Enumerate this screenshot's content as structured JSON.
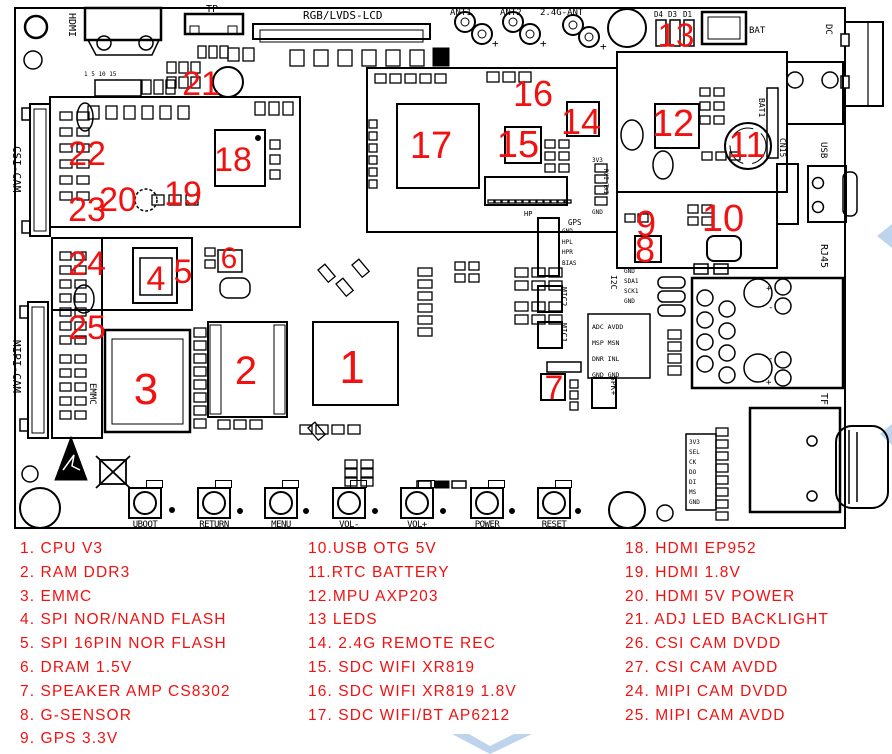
{
  "colors": {
    "annotation": "#f21111",
    "line": "#000000",
    "watermark": "#bdd4ec",
    "bg": "#ffffff"
  },
  "board": {
    "connector_labels": {
      "hdmi": "HDMI",
      "tp": "TP",
      "lcd": "RGB/LVDS-LCD",
      "ant1": "ANT1",
      "ant2": "ANT2",
      "ant_24g": "2.4G-ANT",
      "d4": "D4",
      "d3": "D3",
      "d1": "D1",
      "bat": "BAT",
      "dc": "DC",
      "csi_cam": "CSI-CAM",
      "mipi_cam": "MIPI-CAM",
      "emmc": "EMMC",
      "bat1": "BAT1",
      "cn15": "CN15",
      "usb": "USB",
      "rj45": "RJ45",
      "tf": "TF",
      "mic1": "MIC1",
      "mic2": "MIC2",
      "spk": "SPK+",
      "hp": "HP",
      "gps": "GPS",
      "i2c": "I2C"
    },
    "pins": {
      "hdmi_row": "1 5 10 15",
      "hp": [
        "GND",
        "HPL",
        "HPR",
        "BIAS"
      ],
      "i2c": [
        "GND",
        "SDA1",
        "SCK1",
        "GND"
      ],
      "adc": [
        "ADC AVDD",
        "MSP MSN",
        "DNR INL",
        "GND GND"
      ],
      "tf": [
        "3V3",
        "SEL",
        "CK",
        "DO",
        "DI",
        "MS",
        "GND"
      ],
      "gps_top": "3V3",
      "gps_side": "RXI TXI",
      "gps_bottom": "GND",
      "plus": "+",
      "minus": "-"
    }
  },
  "markers": [
    {
      "n": "1",
      "x": 352,
      "y": 367,
      "s": 46
    },
    {
      "n": "2",
      "x": 246,
      "y": 371,
      "s": 40
    },
    {
      "n": "3",
      "x": 146,
      "y": 390,
      "s": 44
    },
    {
      "n": "4",
      "x": 156,
      "y": 279,
      "s": 34
    },
    {
      "n": "5",
      "x": 183,
      "y": 272,
      "s": 34
    },
    {
      "n": "6",
      "x": 229,
      "y": 259,
      "s": 30
    },
    {
      "n": "7",
      "x": 554,
      "y": 388,
      "s": 34
    },
    {
      "n": "8",
      "x": 645,
      "y": 250,
      "s": 36
    },
    {
      "n": "9",
      "x": 646,
      "y": 224,
      "s": 36
    },
    {
      "n": "10",
      "x": 723,
      "y": 219,
      "s": 38
    },
    {
      "n": "11",
      "x": 747,
      "y": 145,
      "s": 36
    },
    {
      "n": "12",
      "x": 673,
      "y": 124,
      "s": 38
    },
    {
      "n": "13",
      "x": 676,
      "y": 35,
      "s": 33
    },
    {
      "n": "14",
      "x": 581,
      "y": 122,
      "s": 36
    },
    {
      "n": "15",
      "x": 518,
      "y": 145,
      "s": 38
    },
    {
      "n": "16",
      "x": 533,
      "y": 94,
      "s": 36
    },
    {
      "n": "17",
      "x": 431,
      "y": 146,
      "s": 38
    },
    {
      "n": "18",
      "x": 233,
      "y": 160,
      "s": 34
    },
    {
      "n": "19",
      "x": 183,
      "y": 194,
      "s": 34
    },
    {
      "n": "20",
      "x": 118,
      "y": 200,
      "s": 34
    },
    {
      "n": "21",
      "x": 201,
      "y": 84,
      "s": 34
    },
    {
      "n": "22",
      "x": 87,
      "y": 154,
      "s": 34
    },
    {
      "n": "23",
      "x": 87,
      "y": 210,
      "s": 34
    },
    {
      "n": "24",
      "x": 87,
      "y": 264,
      "s": 34
    },
    {
      "n": "25",
      "x": 87,
      "y": 328,
      "s": 34
    }
  ],
  "buttons": [
    {
      "label": "UBOOT",
      "x": 128
    },
    {
      "label": "RETURN",
      "x": 197
    },
    {
      "label": "MENU",
      "x": 264
    },
    {
      "label": "VOL-",
      "x": 332
    },
    {
      "label": "VOL+",
      "x": 400
    },
    {
      "label": "POWER",
      "x": 470
    },
    {
      "label": "RESET",
      "x": 537
    }
  ],
  "legend": {
    "col1": [
      "1. CPU V3",
      "2. RAM DDR3",
      "3. EMMC",
      "4. SPI NOR/NAND FLASH",
      "5. SPI 16PIN NOR FLASH",
      "6. DRAM 1.5V",
      "7. SPEAKER AMP CS8302",
      "8. G-SENSOR",
      "9. GPS 3.3V"
    ],
    "col2": [
      "10.USB OTG 5V",
      "11.RTC BATTERY",
      "12.MPU AXP203",
      "13 LEDS",
      "14. 2.4G REMOTE REC",
      "15. SDC WIFI XR819",
      "16. SDC WIFI XR819 1.8V",
      "17. SDC WIFI/BT AP6212"
    ],
    "col3": [
      "18. HDMI EP952",
      "19. HDMI 1.8V",
      "20. HDMI 5V POWER",
      "21. ADJ LED BACKLIGHT",
      "26. CSI CAM DVDD",
      "27. CSI CAM AVDD",
      "24. MIPI CAM DVDD",
      "25. MIPI CAM AVDD"
    ]
  }
}
